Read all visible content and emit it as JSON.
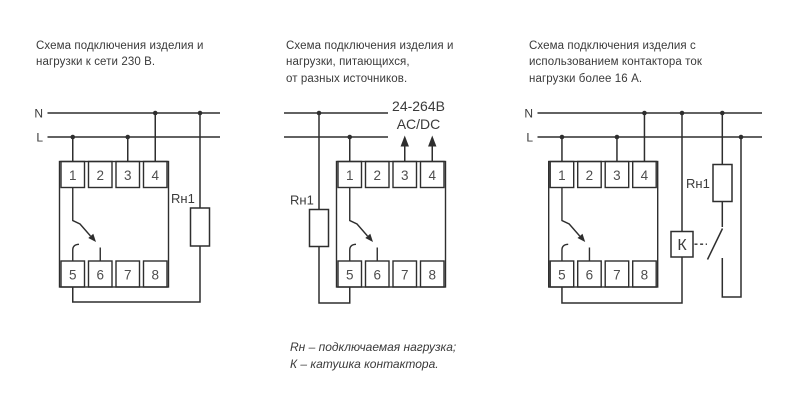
{
  "colors": {
    "background": "#ffffff",
    "stroke": "#2e2e2e",
    "text": "#3a3a3a"
  },
  "diagrams": [
    {
      "id": "mains-230v",
      "title_lines": [
        "Схема подключения изделия и",
        "нагрузки к сети 230 В."
      ],
      "labels": {
        "neutral": "N",
        "line": "L",
        "load": "Rн1"
      }
    },
    {
      "id": "separate-supply",
      "title_lines": [
        "Схема подключения изделия и",
        "нагрузки, питающихся,",
        "от разных источников."
      ],
      "labels": {
        "load": "Rн1",
        "supply_voltage": "24-264В",
        "supply_type": "AC/DC"
      }
    },
    {
      "id": "contactor",
      "title_lines": [
        "Схема подключения изделия с",
        "использованием контактора ток",
        "нагрузки более 16 А."
      ],
      "labels": {
        "neutral": "N",
        "line": "L",
        "load": "Rн1",
        "contactor_coil": "К"
      }
    }
  ],
  "module": {
    "terminals_top": [
      "1",
      "2",
      "3",
      "4"
    ],
    "terminals_bottom": [
      "5",
      "6",
      "7",
      "8"
    ]
  },
  "legend": {
    "line1": "Rн – подключаемая нагрузка;",
    "line2": "К – катушка контактора."
  }
}
